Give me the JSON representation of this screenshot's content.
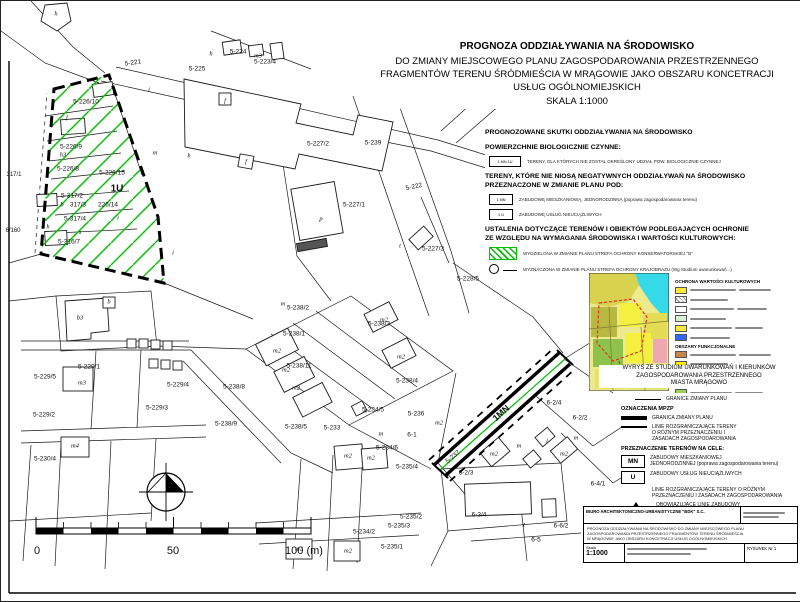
{
  "page": {
    "accent_green": "#00bf00",
    "line_color": "#111111"
  },
  "title": {
    "lines": [
      "PROGNOZA ODDZIAŁYWANIA NA ŚRODOWISKO",
      "DO ZMIANY MIEJSCOWEGO PLANU  ZAGOSPODAROWANIA PRZESTRZENNEGO",
      "FRAGMENTÓW TERENU ŚRÓDMIEŚCIA W MRĄGOWIE JAKO OBSZARU KONCETRACJI",
      "USŁUG OGÓLNOMIEJSKICH",
      "SKALA  1:1000"
    ]
  },
  "legend_env": {
    "heading1": "PROGNOZOWANE SKUTKI ODDZIAŁYWANIA NA ŚRODOWISKO",
    "heading2": "POWIERZCHNIE BIOLOGICZNIE CZYNNE:",
    "item1_box": "1 MN 1U",
    "item1_text": "TERENY, DLA KTÓRYCH NIE ZOSTAŁ OKREŚLONY UDZIAŁ POW. BIOLOGICZNIE CZYNNEJ",
    "heading3a": "TERENY, KTÓRE NIE NIOSĄ NEGATYWNYCH ODDZIAŁYWAŃ NA ŚRODOWISKO",
    "heading3b": "PRZEZNACZONE W ZMIANIE PLANU POD:",
    "item2_box": "1 MN",
    "item2_text": "ZABUDOWĘ MIESZKANIOWĄ, JEDNORODZINNĄ (poprawa zagospodarowania terenu)",
    "item3_box": "1 U",
    "item3_text": "ZABUDOWĘ USŁUG NIEUCIĄŻLIWYCH",
    "heading4a": "USTALENIA DOTYCZĄCE TERENÓW I OBIEKTÓW PODLEGAJĄCYCH OCHRONIE",
    "heading4b": "ZE WZGLĘDU NA WYMAGANIA ŚRODOWISKA I WARTOŚCI KULTUROWYCH:",
    "item4_text": "WYDZIELONA W ZMIANIE PLANU STREFA OCHRONY KONSERWATORSKIEJ \"B\"",
    "item5_text": "WYZNACZONA W ZMIANIE PLANU STREFA OCHRONY KRAJOBRAZU (Wg Studium uwarunkowań...)"
  },
  "inset": {
    "legend_heading1": "OCHRONA WARTOŚCI KULTUROWYCH",
    "legend_heading2": "OBSZARY FUNKCJONALNE",
    "culture_swatches": [
      "#ffe93c",
      "hatch",
      "#ffffff",
      "#d9f0d0",
      "#ffe93c",
      "#3366ff"
    ],
    "function_swatches": [
      "#c8884a",
      "#ffee00",
      "#b8b83a",
      "#f4aab4",
      "#9ccf52",
      "#2fd8e6"
    ],
    "caption_lines": [
      "WYRYS ZE STUDIUM UWARUNKOWAŃ I KIERUNKÓW",
      "ZAGOSPODAROWANIA PRZESTRZENNEGO",
      "MIASTA MRĄGOWO"
    ]
  },
  "legend_mpzp": {
    "granice": "GRANICE ZMIANY PLANU",
    "heading": "OZNACZENIA MPZP",
    "item_granica": "GRANICA ZMIANY PLANU",
    "item_linie": [
      "LINIE ROZGRANICZAJĄCE TERENY",
      "O RÓŻNYM PRZEZNACZENIU I",
      "ZASADACH ZAGOSPODAROWANIA"
    ],
    "heading2": "PRZEZNACZENIE TERENÓW NA CELE:",
    "mn_box": "MN",
    "mn_text": [
      "ZABUDOWY MIESZKANIOWEJ",
      "JEDNORODZINNEJ (poprawa zagospodarowania terenu)"
    ],
    "u_box": "U",
    "u_text": "ZABUDOWY USŁUG NIEUCIĄŻLIWYCH",
    "linie2": [
      "LINIE ROZGRANICZAJĄCE TERENY O RÓŻNYM",
      "PRZEZNACZENIU I ZASADACH ZAGOSPODAROWANIA"
    ],
    "obowiazujace": "OBOWIĄZUJĄCE LINIE ZABUDOWY",
    "nieprzekraczalne": "NIEPRZEKRACZALNE LINIE ZABUDOWY"
  },
  "titleblock": {
    "office": "BIURO ARCHITEKTONICZNO-URBANISTYCZNE \"BDK\" S.C.",
    "project_lines": [
      "PROGNOZA ODDZIAŁYWANIA NA ŚRODOWISKO DO ZMIANY MIEJSCOWEGO PLANU",
      "ZAGOSPODAROWANIA PRZESTRZENNEGO FRAGMENTÓW TERENU ŚRÓDMIEŚCIA",
      "W MRĄGOWIE JAKO OBSZARU KONCETRACJI USŁUG OGÓLNOMIEJSKICH"
    ],
    "scale_label": "Skala",
    "scale_value": "1:1000",
    "drawing_no": "RYSUNEK Nr 1"
  },
  "map": {
    "labels": [
      {
        "t": "5-221",
        "x": 132,
        "y": 62,
        "r": -8
      },
      {
        "t": "5-225",
        "x": 196,
        "y": 68
      },
      {
        "t": "5-224",
        "x": 237,
        "y": 51
      },
      {
        "t": "m3",
        "x": 257,
        "y": 55,
        "i": 1
      },
      {
        "t": "5-223/4",
        "x": 264,
        "y": 61
      },
      {
        "t": "5-226/10",
        "x": 85,
        "y": 101
      },
      {
        "t": "5-226/9",
        "x": 70,
        "y": 146
      },
      {
        "t": "h3",
        "x": 62,
        "y": 154,
        "i": 1
      },
      {
        "t": "5-226/8",
        "x": 67,
        "y": 168
      },
      {
        "t": "5-226/15",
        "x": 111,
        "y": 172
      },
      {
        "t": "1U",
        "x": 116,
        "y": 188,
        "b": 1,
        "s": 10,
        "n": "zone-label-1u"
      },
      {
        "t": "5-317/2",
        "x": 71,
        "y": 195
      },
      {
        "t": "317/3",
        "x": 77,
        "y": 204
      },
      {
        "t": "226/14",
        "x": 107,
        "y": 204
      },
      {
        "t": "5-317/4",
        "x": 74,
        "y": 218
      },
      {
        "t": "s",
        "x": 79,
        "y": 232,
        "i": 1,
        "s": 6
      },
      {
        "t": "5-316/7",
        "x": 68,
        "y": 241
      },
      {
        "t": "317/1",
        "x": 13,
        "y": 174,
        "s": 6
      },
      {
        "t": "6/160",
        "x": 12,
        "y": 230,
        "s": 6
      },
      {
        "t": "i",
        "x": 148,
        "y": 89,
        "i": 1
      },
      {
        "t": "h",
        "x": 210,
        "y": 53,
        "i": 1
      },
      {
        "t": "f",
        "x": 224,
        "y": 100,
        "i": 1
      },
      {
        "t": "m",
        "x": 154,
        "y": 152,
        "i": 1
      },
      {
        "t": "h",
        "x": 188,
        "y": 155,
        "i": 1
      },
      {
        "t": "f",
        "x": 245,
        "y": 161,
        "i": 1
      },
      {
        "t": "i",
        "x": 117,
        "y": 217,
        "i": 1
      },
      {
        "t": "i",
        "x": 172,
        "y": 252,
        "i": 1
      },
      {
        "t": "b",
        "x": 61,
        "y": 204,
        "i": 1
      },
      {
        "t": "h",
        "x": 47,
        "y": 226,
        "i": 1
      },
      {
        "t": "h",
        "x": 55,
        "y": 13,
        "i": 1
      },
      {
        "t": "f",
        "x": 66,
        "y": 117,
        "i": 1,
        "s": 6
      },
      {
        "t": "5-227/2",
        "x": 317,
        "y": 143
      },
      {
        "t": "5-239",
        "x": 372,
        "y": 142
      },
      {
        "t": "5-222",
        "x": 413,
        "y": 186,
        "r": -12
      },
      {
        "t": "5-227/1",
        "x": 353,
        "y": 204
      },
      {
        "t": "p",
        "x": 320,
        "y": 218,
        "i": 1
      },
      {
        "t": "5-227/3",
        "x": 432,
        "y": 248
      },
      {
        "t": "t",
        "x": 399,
        "y": 245,
        "i": 1
      },
      {
        "t": "5-228/5",
        "x": 467,
        "y": 278
      },
      {
        "t": "5-238/2",
        "x": 297,
        "y": 307
      },
      {
        "t": "5-238/1",
        "x": 293,
        "y": 333
      },
      {
        "t": "5-238/11",
        "x": 298,
        "y": 365
      },
      {
        "t": "5-238/3",
        "x": 378,
        "y": 323
      },
      {
        "t": "5-238/8",
        "x": 233,
        "y": 386
      },
      {
        "t": "5-238/4",
        "x": 406,
        "y": 380
      },
      {
        "t": "5-238/9",
        "x": 225,
        "y": 423
      },
      {
        "t": "5-238/5",
        "x": 295,
        "y": 426
      },
      {
        "t": "5-233",
        "x": 331,
        "y": 427
      },
      {
        "t": "5-234/5",
        "x": 372,
        "y": 409
      },
      {
        "t": "5-234/6",
        "x": 386,
        "y": 447
      },
      {
        "t": "5-235/4",
        "x": 406,
        "y": 466
      },
      {
        "t": "6-1",
        "x": 411,
        "y": 434
      },
      {
        "t": "5-237",
        "x": 452,
        "y": 456,
        "r": -40
      },
      {
        "t": "6-2/3",
        "x": 465,
        "y": 472
      },
      {
        "t": "6-2/4",
        "x": 553,
        "y": 402
      },
      {
        "t": "6-2/2",
        "x": 579,
        "y": 417
      },
      {
        "t": "6-4/1",
        "x": 597,
        "y": 483
      },
      {
        "t": "6-3/4",
        "x": 478,
        "y": 514
      },
      {
        "t": "6-6/2",
        "x": 560,
        "y": 525
      },
      {
        "t": "6-5",
        "x": 535,
        "y": 539
      },
      {
        "t": "5-236",
        "x": 415,
        "y": 413
      },
      {
        "t": "1MN",
        "x": 500,
        "y": 412,
        "b": 1,
        "s": 9,
        "r": -42,
        "n": "zone-label-1mn"
      },
      {
        "t": "5-229/1",
        "x": 88,
        "y": 366
      },
      {
        "t": "m3",
        "x": 81,
        "y": 382,
        "i": 1
      },
      {
        "t": "5-229/5",
        "x": 44,
        "y": 376
      },
      {
        "t": "5-229/4",
        "x": 177,
        "y": 384
      },
      {
        "t": "5-229/2",
        "x": 43,
        "y": 414
      },
      {
        "t": "5-229/3",
        "x": 156,
        "y": 407
      },
      {
        "t": "m4",
        "x": 74,
        "y": 445,
        "i": 1
      },
      {
        "t": "5-230/4",
        "x": 44,
        "y": 458
      },
      {
        "t": "b3",
        "x": 79,
        "y": 317,
        "i": 1
      },
      {
        "t": "b",
        "x": 108,
        "y": 301,
        "i": 1
      },
      {
        "t": "5-235/2",
        "x": 410,
        "y": 516
      },
      {
        "t": "5-235/3",
        "x": 398,
        "y": 525
      },
      {
        "t": "5-234/2",
        "x": 363,
        "y": 531
      },
      {
        "t": "5-235/1",
        "x": 391,
        "y": 546
      },
      {
        "t": "m2",
        "x": 276,
        "y": 350,
        "i": 1
      },
      {
        "t": "m2",
        "x": 285,
        "y": 369,
        "i": 1
      },
      {
        "t": "m2",
        "x": 295,
        "y": 387,
        "i": 1
      },
      {
        "t": "m2",
        "x": 383,
        "y": 319,
        "i": 1
      },
      {
        "t": "m2",
        "x": 400,
        "y": 356,
        "i": 1
      },
      {
        "t": "m2",
        "x": 438,
        "y": 422,
        "i": 1
      },
      {
        "t": "m2",
        "x": 347,
        "y": 455,
        "i": 1
      },
      {
        "t": "m2",
        "x": 370,
        "y": 457,
        "i": 1
      },
      {
        "t": "m2",
        "x": 298,
        "y": 548,
        "i": 1
      },
      {
        "t": "m2",
        "x": 347,
        "y": 550,
        "i": 1
      },
      {
        "t": "m2",
        "x": 493,
        "y": 453,
        "i": 1
      },
      {
        "t": "m2",
        "x": 563,
        "y": 453,
        "i": 1
      },
      {
        "t": "m",
        "x": 282,
        "y": 303,
        "i": 1
      },
      {
        "t": "m",
        "x": 380,
        "y": 433,
        "i": 1
      },
      {
        "t": "m",
        "x": 518,
        "y": 445,
        "i": 1
      },
      {
        "t": "m",
        "x": 575,
        "y": 437,
        "i": 1
      },
      {
        "t": "i",
        "x": 546,
        "y": 440,
        "i": 1
      },
      {
        "t": "t",
        "x": 365,
        "y": 410,
        "i": 1
      },
      {
        "t": "t",
        "x": 523,
        "y": 524,
        "i": 1
      },
      {
        "t": "t",
        "x": 135,
        "y": 343,
        "i": 1,
        "s": 5.5
      },
      {
        "t": "t",
        "x": 160,
        "y": 363,
        "i": 1,
        "s": 5.5
      },
      {
        "t": "0",
        "x": 36,
        "y": 550,
        "s": 11,
        "n": "scale-label"
      },
      {
        "t": "50",
        "x": 172,
        "y": 550,
        "s": 11,
        "n": "scale-label"
      },
      {
        "t": "100 (m)",
        "x": 303,
        "y": 550,
        "s": 11,
        "n": "scale-label"
      }
    ]
  }
}
